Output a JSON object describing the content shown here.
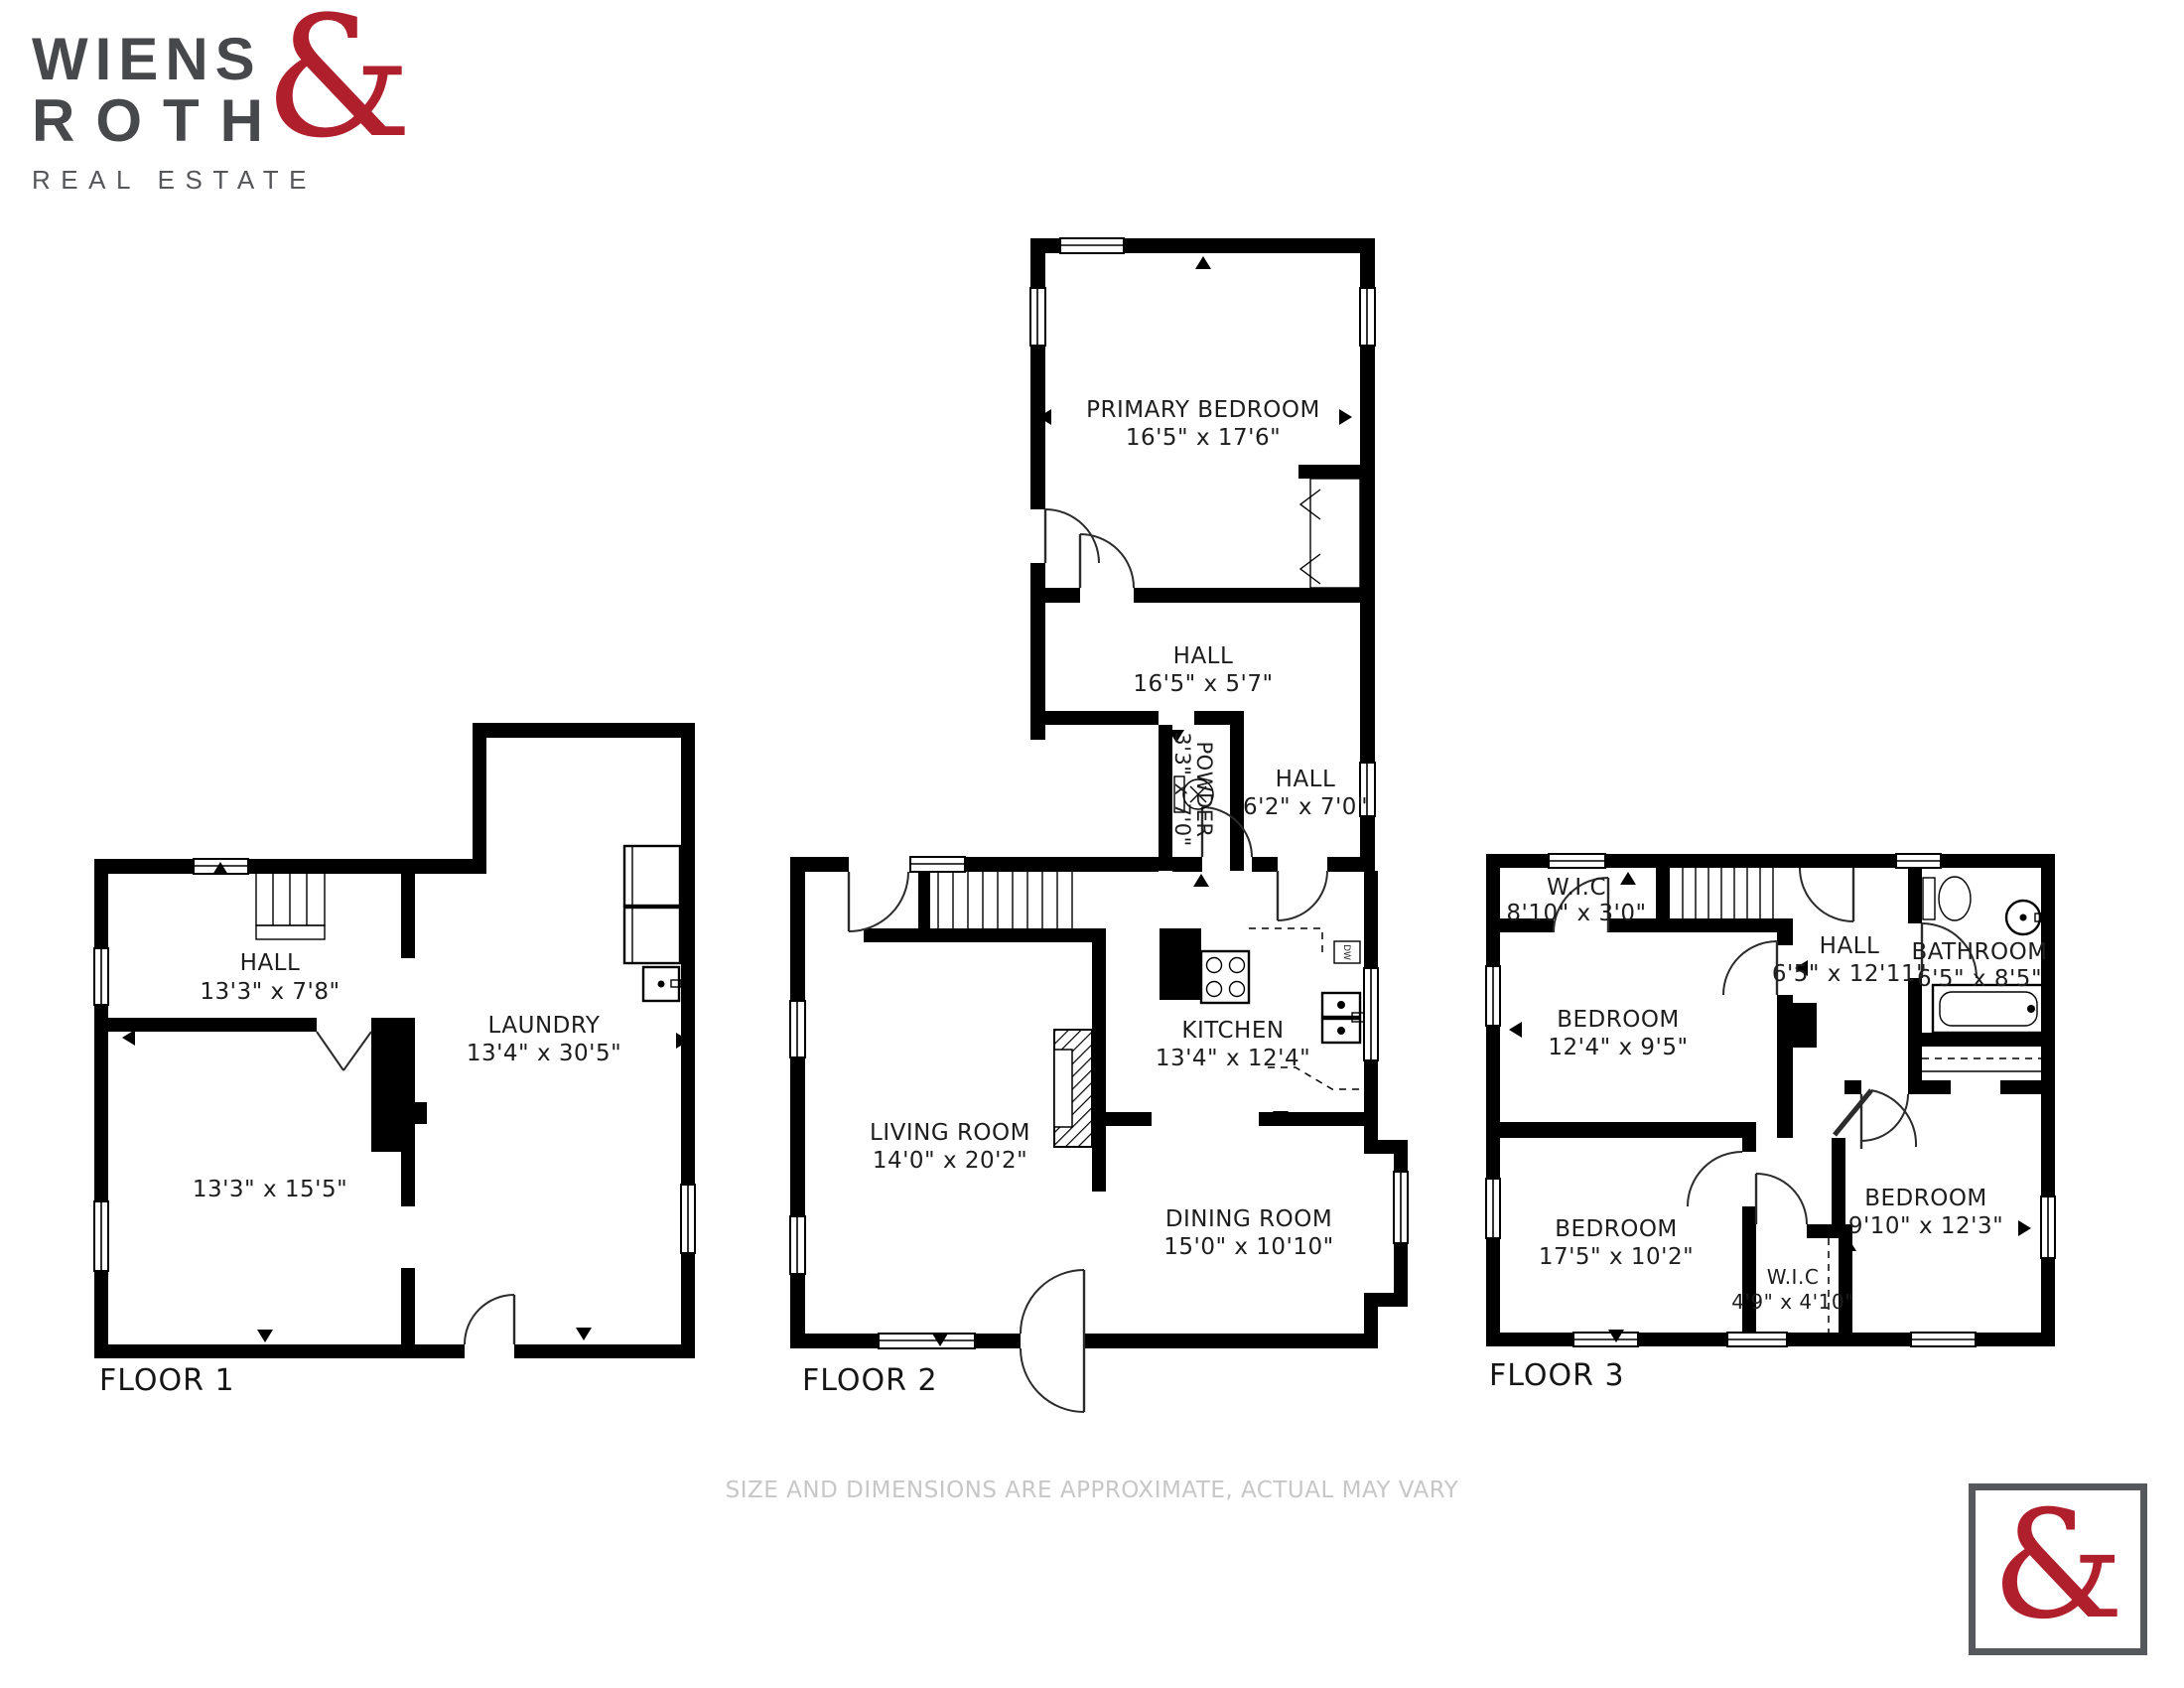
{
  "brand": {
    "name_line1": "WIENS",
    "name_line2": "ROTH",
    "ampersand": "&",
    "tagline": "REAL ESTATE",
    "accent_color": "#b01f2c",
    "text_color": "#47484b"
  },
  "floors": [
    {
      "label": "FLOOR 1",
      "rooms": {
        "hall": {
          "name": "HALL",
          "dims": "13'3\" x 7'8\""
        },
        "room": {
          "name": "",
          "dims": "13'3\" x 15'5\""
        },
        "laundry": {
          "name": "LAUNDRY",
          "dims": "13'4\" x 30'5\""
        }
      }
    },
    {
      "label": "FLOOR 2",
      "rooms": {
        "primary_bedroom": {
          "name": "PRIMARY BEDROOM",
          "dims": "16'5\" x 17'6\""
        },
        "hall_upper": {
          "name": "HALL",
          "dims": "16'5\" x 5'7\""
        },
        "powder": {
          "name": "POWDER",
          "dims": "3'3\" x 7'0\""
        },
        "hall_lower": {
          "name": "HALL",
          "dims": "6'2\" x 7'0\""
        },
        "kitchen": {
          "name": "KITCHEN",
          "dims": "13'4\" x 12'4\""
        },
        "living_room": {
          "name": "LIVING ROOM",
          "dims": "14'0\" x 20'2\""
        },
        "dining_room": {
          "name": "DINING ROOM",
          "dims": "15'0\" x 10'10\""
        }
      },
      "appliances": {
        "dishwasher": "DW"
      }
    },
    {
      "label": "FLOOR 3",
      "rooms": {
        "wic_top": {
          "name": "W.I.C",
          "dims": "8'10\" x 3'0\""
        },
        "hall": {
          "name": "HALL",
          "dims": "6'5\" x 12'11\""
        },
        "bathroom": {
          "name": "BATHROOM",
          "dims": "6'5\" x 8'5\""
        },
        "bedroom_left": {
          "name": "BEDROOM",
          "dims": "12'4\" x 9'5\""
        },
        "bedroom_bottom": {
          "name": "BEDROOM",
          "dims": "17'5\" x 10'2\""
        },
        "wic_bottom": {
          "name": "W.I.C",
          "dims": "4'9\" x 4'10\""
        },
        "bedroom_right": {
          "name": "BEDROOM",
          "dims": "9'10\" x 12'3\""
        }
      }
    }
  ],
  "disclaimer": "SIZE AND DIMENSIONS ARE APPROXIMATE, ACTUAL MAY VARY",
  "footer_logo": {
    "ampersand": "&"
  }
}
